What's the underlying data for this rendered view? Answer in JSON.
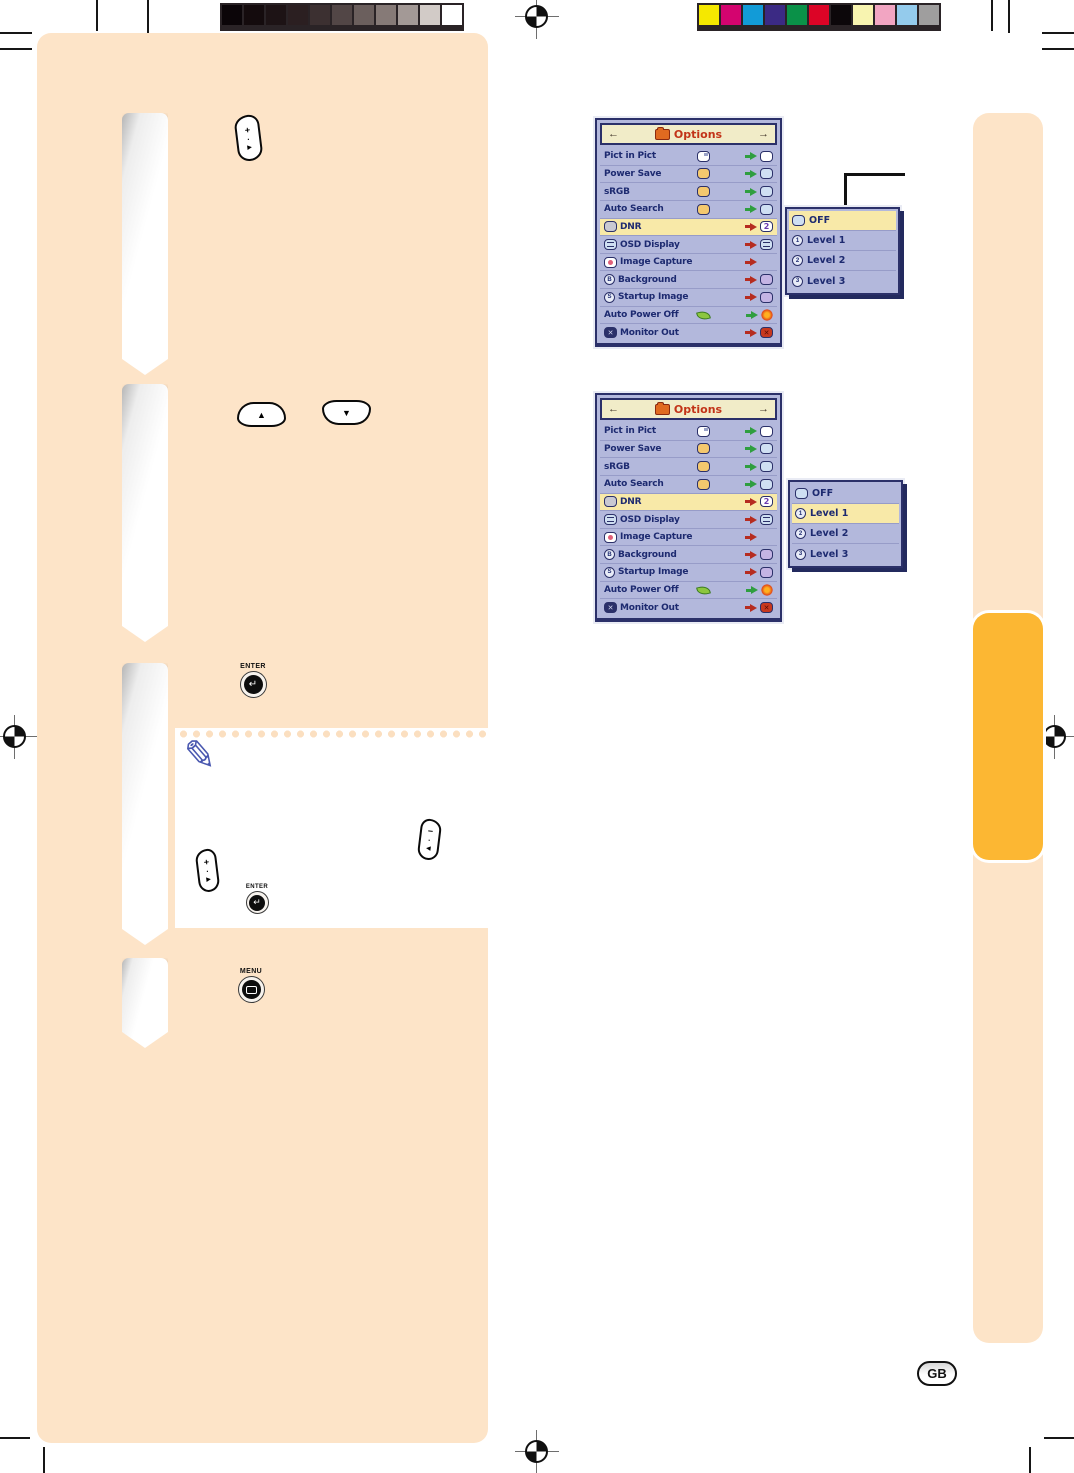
{
  "page": {
    "language_badge": "GB"
  },
  "colors": {
    "panel_peach": "#fde4c8",
    "tab_orange": "#fcb733",
    "menu_bg": "#b3b8dc",
    "menu_border": "#2b3069",
    "menu_header_bg": "#f1ecc8",
    "menu_title_red": "#c23318",
    "highlight_row": "#f8e9a8",
    "label_navy": "#1d2a70"
  },
  "grayscale_bar": [
    "#0b0508",
    "#140b0d",
    "#1d1315",
    "#2b1f21",
    "#3c3031",
    "#524646",
    "#6b5f5d",
    "#867a77",
    "#a39996",
    "#d2cbc7",
    "#ffffff"
  ],
  "color_bar": [
    "#f5e800",
    "#d4046f",
    "#129bd7",
    "#3b2a84",
    "#0a9148",
    "#dc0426",
    "#0c070a",
    "#f8f4b0",
    "#f2a5c2",
    "#94cbec",
    "#9f9e9e"
  ],
  "osd_menu": {
    "title": "Options",
    "left_arrow": "←",
    "right_arrow": "→",
    "items": [
      {
        "label": "Pict in Pict"
      },
      {
        "label": "Power Save"
      },
      {
        "label": "sRGB"
      },
      {
        "label": "Auto Search"
      },
      {
        "label": "DNR",
        "value": "2"
      },
      {
        "label": "OSD Display"
      },
      {
        "label": "Image Capture"
      },
      {
        "label": "Background",
        "glyph": "B"
      },
      {
        "label": "Startup Image",
        "glyph": "S"
      },
      {
        "label": "Auto Power Off"
      },
      {
        "label": "Monitor Out"
      }
    ]
  },
  "dnr_submenu": {
    "items": [
      {
        "label": "OFF"
      },
      {
        "label": "Level 1",
        "num": "1"
      },
      {
        "label": "Level 2",
        "num": "2"
      },
      {
        "label": "Level 3",
        "num": "3"
      }
    ]
  },
  "buttons": {
    "enter": "ENTER",
    "menu": "MENU",
    "up": "▲",
    "down": "▼",
    "right": "▶",
    "left": "◀",
    "plus": "+",
    "minus": "−",
    "dot": "·",
    "enter_glyph": "↵"
  },
  "icons": {
    "note_pencil": "✎",
    "cross": "✕"
  }
}
